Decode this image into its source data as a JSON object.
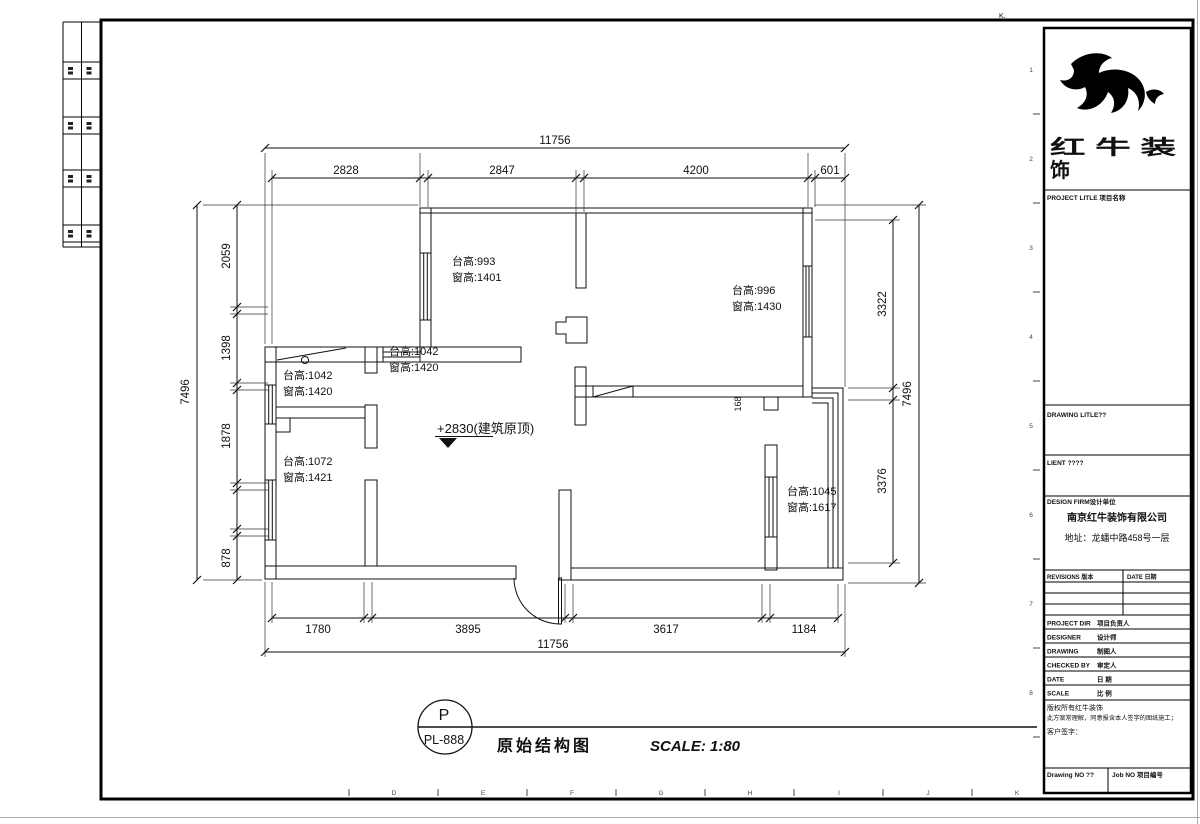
{
  "frame": {
    "corner_letter": "K.",
    "bottom_letters": [
      "D",
      "E",
      "F",
      "G",
      "H",
      "I",
      "J",
      "K"
    ],
    "right_numbers": [
      "1",
      "2",
      "3",
      "4",
      "5",
      "6",
      "7",
      "8"
    ]
  },
  "plan": {
    "level_label": "+2830(建筑原顶)",
    "small_dim": "168",
    "annotations": [
      {
        "line1": "台高:993",
        "line2": "窗高:1401"
      },
      {
        "line1": "台高:996",
        "line2": "窗高:1430"
      },
      {
        "line1": "台高:1042",
        "line2": "窗高:1420"
      },
      {
        "line1": "台高:1042",
        "line2": "窗高:1420"
      },
      {
        "line1": "台高:1072",
        "line2": "窗高:1421"
      },
      {
        "line1": "台高:1045",
        "line2": "窗高:1617"
      }
    ],
    "dims": {
      "top_total": "11756",
      "top": [
        "2828",
        "2847",
        "4200",
        "601"
      ],
      "bottom_total": "11756",
      "bottom": [
        "1780",
        "3895",
        "3617",
        "1184"
      ],
      "left_total": "7496",
      "left": [
        "2059",
        "1398",
        "1878",
        "878"
      ],
      "right_total": "7496",
      "right": [
        "3322",
        "3376"
      ]
    }
  },
  "stamp": {
    "letter": "P",
    "code": "PL-888"
  },
  "footer": {
    "drawing_title": "原始结构图",
    "scale": "SCALE: 1:80"
  },
  "title_block": {
    "brand_line1": "红 牛 装",
    "brand_line2": "饰",
    "project_title": "PROJECT LITLE 项目名称",
    "drawing_title_label": "DRAWING LITLE??",
    "client_label": "LIENT ????",
    "design_firm_label": "DESIGN FIRM设计单位",
    "firm_name": "南京红牛装饰有限公司",
    "firm_address": "地址：龙蟠中路458号一层",
    "revisions_label": "REVISIONS 版本",
    "date_label": "DATE 日期",
    "rows": [
      {
        "en": "PROJECT DIR",
        "cn": "项目负责人"
      },
      {
        "en": "DESIGNER",
        "cn": "设计师"
      },
      {
        "en": "DRAWING",
        "cn": "制图人"
      },
      {
        "en": "CHECKED BY",
        "cn": "审定人"
      },
      {
        "en": "DATE",
        "cn": "日 期"
      },
      {
        "en": "SCALE",
        "cn": "比 例"
      }
    ],
    "note1": "版权所有红牛装饰",
    "note2": "此方案常理解，同意报含本人签字的图纸施工；",
    "note3": "客户签字：",
    "drawing_no": "Drawing NO ??",
    "job_no": "Job NO 项目编号"
  }
}
